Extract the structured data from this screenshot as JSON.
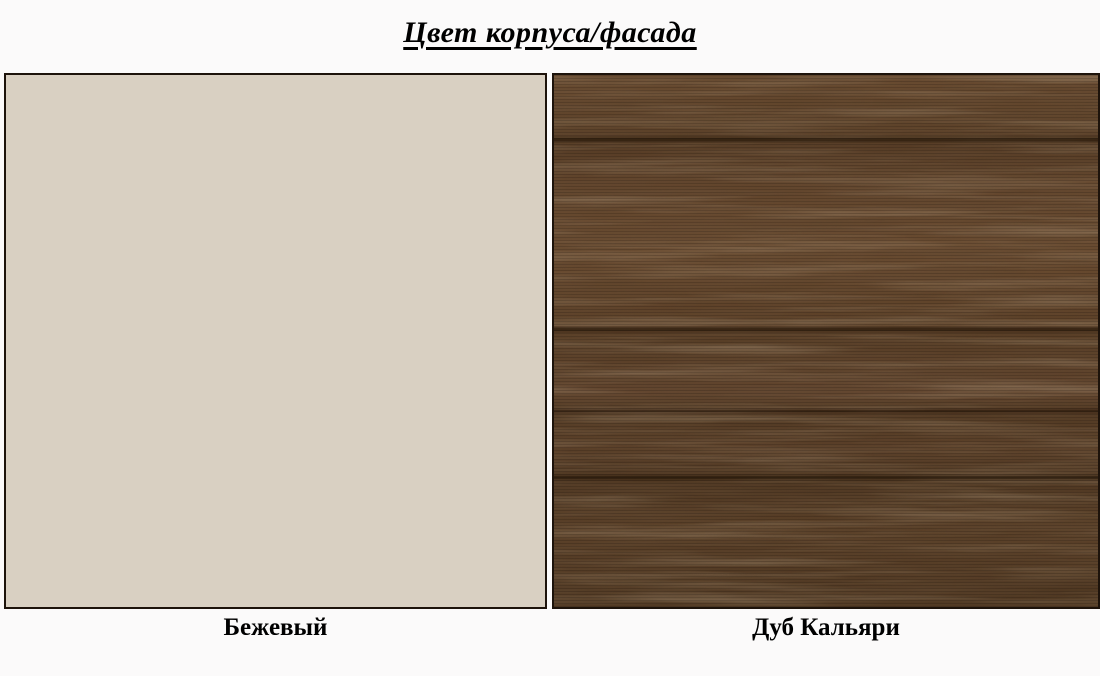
{
  "page": {
    "title": "Цвет корпуса/фасада"
  },
  "swatches": [
    {
      "label": "Бежевый",
      "type": "solid-color-sample",
      "color": "#d9d0c2"
    },
    {
      "label": "Дуб Кальяри",
      "type": "wood-texture-sample",
      "base_color": "#5e4229",
      "dark_grain_color": "#34220f",
      "light_grain_color": "#8a6744"
    }
  ],
  "colors": {
    "background": "#fbfafa",
    "border": "#1d130b",
    "text": "#000000"
  }
}
